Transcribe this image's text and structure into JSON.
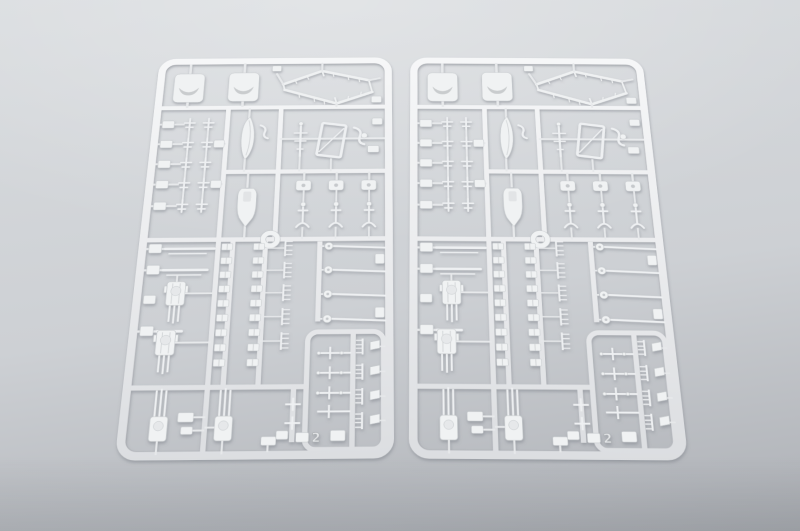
{
  "scene": {
    "type": "product-photograph",
    "subject": "Two identical light-gray injection-molded styrene sprues of ship model kit parts lying side by side on a plain gray studio background",
    "sprue_count": 2,
    "colors": {
      "bg-top": "#d9dcdf",
      "bg-mid": "#cdd0d4",
      "bg-bottom": "#b4b7bc",
      "plastic": "#f0f2f3",
      "plastic-deep": "#dcdee1",
      "plastic-edge": "#c3c7ca",
      "cast-shadow": "#787d84"
    }
  },
  "sprue": {
    "mold_number": "2",
    "notable_parts": [
      "turret-base-plates",
      "hexagonal-rail-frame",
      "ships-boat-hull",
      "motor-launch-hull",
      "barbette-ring",
      "aa-gun-mounts",
      "triple-gun-turrets",
      "gun-barrels",
      "anchors",
      "ladders-and-small-fittings"
    ]
  }
}
